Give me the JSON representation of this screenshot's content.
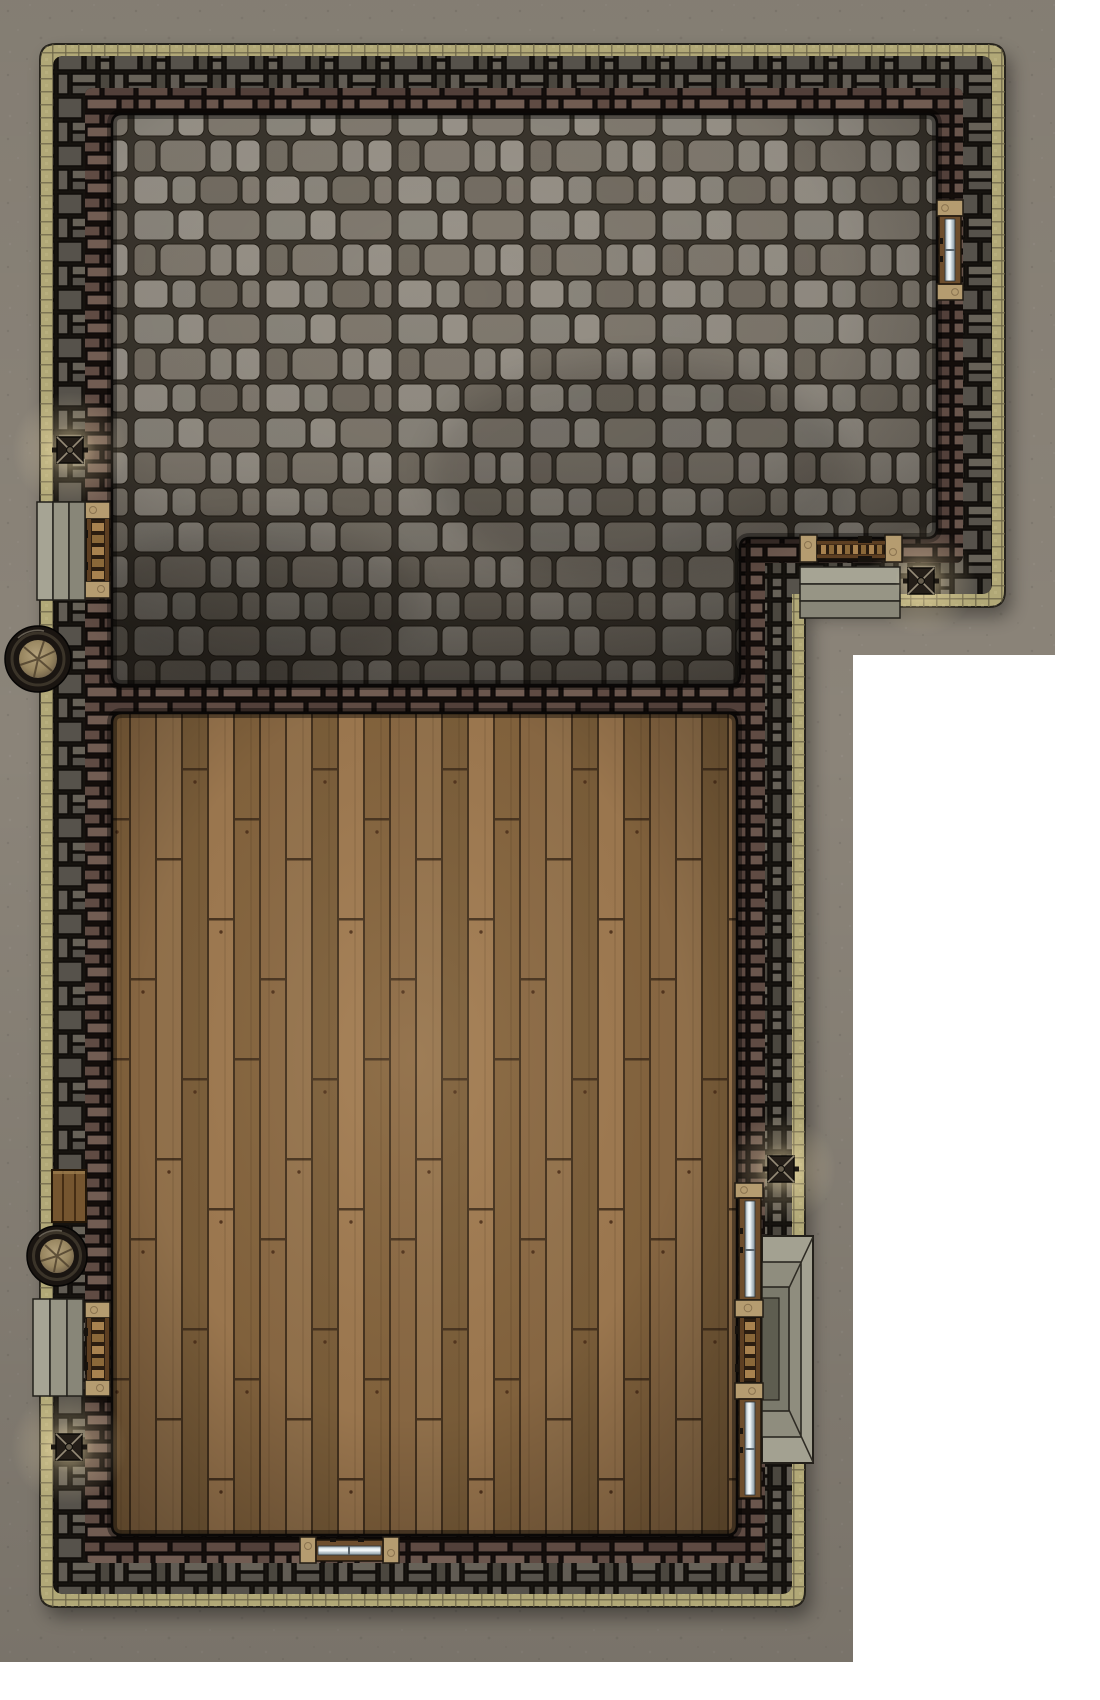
{
  "meta": {
    "type": "top-down battle map",
    "subject": "L-shaped building floor plan with stone hall and wood hall",
    "canvas": {
      "width": 1100,
      "height": 1700
    },
    "grid_visible": false
  },
  "palette": {
    "white": "#ffffff",
    "ground": "#8b8479",
    "trim": "#b1a877",
    "trim_tick": "#6b6347",
    "wall_mortar": "#16130f",
    "inner_mortar": "#140e0b",
    "stone_mortar": "#3b362e",
    "plank_gap": "#46331f",
    "step_stone": "#9b9989",
    "lintel": "#b59c70",
    "door_wood": "#96703f",
    "glass": "#cfdde3",
    "metal": "#221c16",
    "glow": "#ffe2a8"
  },
  "scene": {
    "rooms": [
      {
        "name": "Stone-floor hall",
        "floor": "cobblestone"
      },
      {
        "name": "Wood-floor hall",
        "floor": "wood planks"
      }
    ],
    "feature_counts": {
      "doors": 4,
      "windows": 4,
      "wall_lanterns": 4,
      "barrels": 2,
      "crates": 1,
      "step_sets": 3,
      "porches": 1
    },
    "objects": [
      {
        "name": "Courtyard ground",
        "kind": "ground"
      },
      {
        "name": "Building outer trim",
        "kind": "wall-trim"
      },
      {
        "name": "Outer stone-brick wall",
        "kind": "wall"
      },
      {
        "name": "Interior brick walls",
        "kind": "wall"
      },
      {
        "name": "Stone-floor hall",
        "kind": "room",
        "bbox": [
          112,
          114,
          825,
          571
        ]
      },
      {
        "name": "Wood-floor hall",
        "kind": "room",
        "bbox": [
          112,
          713,
          625,
          822
        ]
      },
      {
        "name": "Window - stone hall east wall",
        "kind": "window",
        "bbox": [
          937,
          200,
          26,
          100
        ]
      },
      {
        "name": "Door - stone hall west wall",
        "kind": "door",
        "bbox": [
          85,
          502,
          25,
          96
        ]
      },
      {
        "name": "Steps - west upper entrance",
        "kind": "steps",
        "bbox": [
          37,
          502,
          48,
          98
        ]
      },
      {
        "name": "Wall lantern - west upper",
        "kind": "lantern",
        "cx": 70,
        "cy": 450
      },
      {
        "name": "Barrel - upper west",
        "kind": "barrel",
        "cx": 38,
        "cy": 659,
        "r": 33
      },
      {
        "name": "Door - stone hall southeast",
        "kind": "door",
        "bbox": [
          800,
          535,
          102,
          27
        ]
      },
      {
        "name": "Steps - southeast entrance",
        "kind": "steps",
        "bbox": [
          800,
          567,
          100,
          51
        ]
      },
      {
        "name": "Wall lantern - southeast",
        "kind": "lantern",
        "cx": 921,
        "cy": 581
      },
      {
        "name": "Crate - west wall",
        "kind": "crate",
        "bbox": [
          52,
          1170,
          34,
          52
        ]
      },
      {
        "name": "Barrel - lower west",
        "kind": "barrel",
        "cx": 57,
        "cy": 1256,
        "r": 30
      },
      {
        "name": "Door - wood hall west wall",
        "kind": "door",
        "bbox": [
          85,
          1302,
          25,
          94
        ]
      },
      {
        "name": "Steps - west lower entrance",
        "kind": "steps",
        "bbox": [
          33,
          1299,
          50,
          97
        ]
      },
      {
        "name": "Wall lantern - west lower",
        "kind": "lantern",
        "cx": 69,
        "cy": 1447
      },
      {
        "name": "Wall lantern - east",
        "kind": "lantern",
        "cx": 781,
        "cy": 1169
      },
      {
        "name": "Window - wood hall east upper",
        "kind": "window",
        "bbox": [
          735,
          1183,
          28,
          134
        ]
      },
      {
        "name": "Door - wood hall east wall",
        "kind": "door",
        "bbox": [
          735,
          1300,
          28,
          99
        ]
      },
      {
        "name": "Window - wood hall east lower",
        "kind": "window",
        "bbox": [
          735,
          1383,
          28,
          115
        ]
      },
      {
        "name": "Porch steps - east entrance",
        "kind": "porch",
        "bbox": [
          762,
          1236,
          51,
          227
        ]
      },
      {
        "name": "Window - wood hall south wall",
        "kind": "window",
        "bbox": [
          300,
          1537,
          99,
          26
        ]
      },
      {
        "name": "White margin",
        "kind": "background"
      }
    ]
  }
}
